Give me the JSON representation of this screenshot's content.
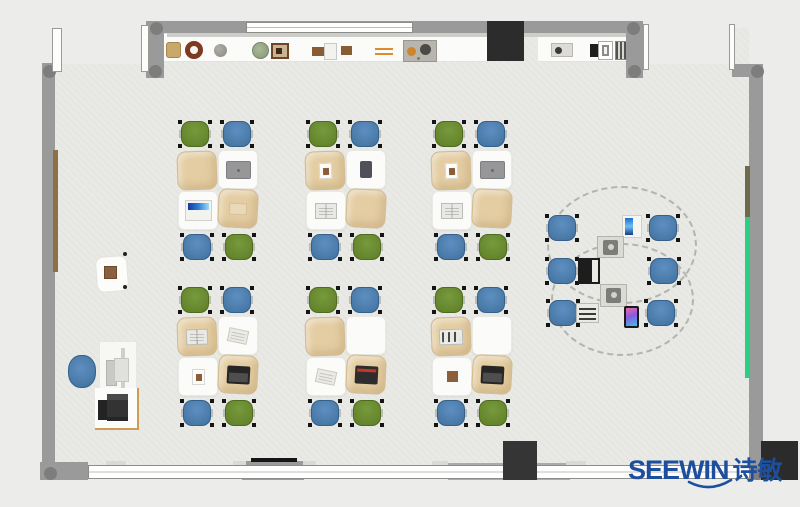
{
  "brand": {
    "name": "SEEWIN",
    "name_cn": "诗敏",
    "logo_color": "#1d4f9e"
  },
  "palette": {
    "bg": "#ececeb",
    "floor": "#e9e9e6",
    "wall": "#9a9a9a",
    "wall_joint": "#7d7d7d",
    "window_white": "#ffffff",
    "shelf_white": "#fbfbf9",
    "chair_green": "#5f7e28",
    "chair_blue": "#41719c",
    "desk_white": "#fbfbf9",
    "desk_tan": "#e4cda2",
    "tv_black": "#2c2c2c",
    "cabinet_dark": "#353535",
    "pillar_dark": "#2b2b2b",
    "strip_green": "#2bcf84",
    "strip_brown_left": "#8f6f45",
    "strip_brown_right": "#6f6b4a",
    "trim_tan": "#cf9d52"
  },
  "structure": {
    "floor": {
      "x": 55,
      "y": 28,
      "w": 694,
      "h": 439
    },
    "notches": [
      {
        "n": "door-recess-top-left",
        "x": 55,
        "y": 20,
        "w": 91,
        "h": 44
      },
      {
        "n": "door-recess-top-right",
        "x": 643,
        "y": 16,
        "w": 90,
        "h": 48
      }
    ],
    "walls": [
      {
        "n": "wall-top",
        "x": 150,
        "y": 21,
        "w": 490,
        "h": 12
      },
      {
        "n": "wall-top-left-pier",
        "x": 146,
        "y": 21,
        "w": 18,
        "h": 57
      },
      {
        "n": "wall-top-right-corner",
        "x": 626,
        "y": 21,
        "w": 17,
        "h": 57
      },
      {
        "n": "wall-top-right",
        "x": 732,
        "y": 64,
        "w": 31,
        "h": 13
      },
      {
        "n": "wall-right",
        "x": 749,
        "y": 64,
        "w": 14,
        "h": 416
      },
      {
        "n": "wall-left",
        "x": 42,
        "y": 63,
        "w": 13,
        "h": 404
      },
      {
        "n": "wall-bottom-left-corner",
        "x": 40,
        "y": 462,
        "w": 48,
        "h": 18
      },
      {
        "n": "wall-bottom-pier-center",
        "x": 242,
        "y": 461,
        "w": 62,
        "h": 19
      },
      {
        "n": "wall-bottom-pier-right",
        "x": 448,
        "y": 463,
        "w": 122,
        "h": 17,
        "bg": "#ababab"
      }
    ],
    "wall_edge": {
      "x": 167,
      "y": 33,
      "w": 460,
      "h": 4
    },
    "joints": [
      [
        150,
        22
      ],
      [
        627,
        22
      ],
      [
        149,
        65
      ],
      [
        628,
        65
      ],
      [
        751,
        65
      ],
      [
        43,
        65
      ],
      [
        44,
        467
      ],
      [
        751,
        467
      ]
    ],
    "windows": [
      {
        "n": "window-top",
        "x": 246,
        "y": 22,
        "w": 167,
        "h": 11
      },
      {
        "n": "window-bottom",
        "x": 88,
        "y": 465,
        "w": 662,
        "h": 14
      }
    ],
    "window_tabs": [
      [
        106,
        461,
        20
      ],
      [
        233,
        461,
        13
      ],
      [
        303,
        461,
        13
      ],
      [
        432,
        461,
        16
      ],
      [
        566,
        461,
        20
      ],
      [
        648,
        461,
        14
      ]
    ],
    "door_jambs": [
      [
        52,
        28,
        10,
        44
      ],
      [
        141,
        25,
        8,
        47
      ],
      [
        643,
        24,
        6,
        46
      ],
      [
        729,
        24,
        6,
        46
      ]
    ],
    "black_line": {
      "x": 251,
      "y": 458,
      "w": 46,
      "h": 4
    },
    "wall_strips": [
      {
        "n": "rail-brown-left",
        "x": 53,
        "y": 150,
        "w": 5,
        "h": 122,
        "bg": "#8f6f45"
      },
      {
        "n": "rail-brown-right",
        "x": 745,
        "y": 166,
        "w": 5,
        "h": 52,
        "bg": "#6f6b4a"
      },
      {
        "n": "rail-green-right",
        "x": 745,
        "y": 217,
        "w": 5,
        "h": 161,
        "bg": "#2bcf84"
      }
    ],
    "blocks": [
      {
        "n": "tv-panel",
        "x": 487,
        "y": 21,
        "w": 37,
        "h": 40,
        "bg": "#2c2c2c"
      },
      {
        "n": "cabinet-bottom",
        "x": 503,
        "y": 441,
        "w": 34,
        "h": 39,
        "bg": "#353535"
      },
      {
        "n": "pillar-bottom-right",
        "x": 761,
        "y": 441,
        "w": 37,
        "h": 39,
        "bg": "#2b2b2b"
      }
    ]
  },
  "shelf": {
    "bands": [
      {
        "x": 164,
        "y": 34,
        "w": 324,
        "h": 28
      },
      {
        "x": 538,
        "y": 34,
        "w": 108,
        "h": 28
      }
    ],
    "items": [
      {
        "t": "basket",
        "x": 166,
        "y": 42,
        "w": 15,
        "h": 16
      },
      {
        "t": "wreath",
        "x": 185,
        "y": 41,
        "w": 18,
        "h": 18
      },
      {
        "t": "ball",
        "x": 214,
        "y": 44,
        "w": 13,
        "h": 13
      },
      {
        "t": "plant",
        "x": 252,
        "y": 42,
        "w": 17,
        "h": 17
      },
      {
        "t": "frame",
        "x": 271,
        "y": 43,
        "w": 18,
        "h": 16
      },
      {
        "t": "box",
        "x": 312,
        "y": 47,
        "w": 13,
        "h": 9
      },
      {
        "t": "case",
        "x": 324,
        "y": 43,
        "w": 13,
        "h": 17
      },
      {
        "t": "box",
        "x": 341,
        "y": 46,
        "w": 11,
        "h": 9
      },
      {
        "t": "rails",
        "x": 375,
        "y": 48,
        "w": 18,
        "h": 7
      },
      {
        "t": "tray",
        "x": 403,
        "y": 40,
        "w": 34,
        "h": 22
      },
      {
        "t": "knob",
        "x": 551,
        "y": 43,
        "w": 22,
        "h": 14
      },
      {
        "t": "copier",
        "x": 590,
        "y": 41,
        "w": 23,
        "h": 18
      },
      {
        "t": "grille",
        "x": 615,
        "y": 41,
        "w": 13,
        "h": 19
      }
    ]
  },
  "clusters": [
    {
      "x": 177,
      "y": 119,
      "chairs": [
        "g",
        "b",
        "b",
        "g"
      ],
      "desks": [
        {
          "c": "tan",
          "i": "none"
        },
        {
          "c": "white",
          "i": "tabletgray"
        },
        {
          "c": "white",
          "i": "screenblue"
        },
        {
          "c": "tan",
          "i": "pencil"
        }
      ]
    },
    {
      "x": 305,
      "y": 119,
      "chairs": [
        "g",
        "b",
        "b",
        "g"
      ],
      "desks": [
        {
          "c": "tan",
          "i": "photo"
        },
        {
          "c": "white",
          "i": "tabletdark"
        },
        {
          "c": "white",
          "i": "book"
        },
        {
          "c": "tan",
          "i": "none"
        }
      ]
    },
    {
      "x": 431,
      "y": 119,
      "chairs": [
        "g",
        "b",
        "b",
        "g"
      ],
      "desks": [
        {
          "c": "tan",
          "i": "photo"
        },
        {
          "c": "white",
          "i": "tabletgray"
        },
        {
          "c": "white",
          "i": "book"
        },
        {
          "c": "tan",
          "i": "none"
        }
      ]
    },
    {
      "x": 177,
      "y": 285,
      "chairs": [
        "g",
        "b",
        "b",
        "g"
      ],
      "desks": [
        {
          "c": "tan",
          "i": "book"
        },
        {
          "c": "white",
          "i": "news"
        },
        {
          "c": "white",
          "i": "photo"
        },
        {
          "c": "tan",
          "i": "laptopdark"
        }
      ]
    },
    {
      "x": 305,
      "y": 285,
      "chairs": [
        "g",
        "b",
        "b",
        "g"
      ],
      "desks": [
        {
          "c": "tan",
          "i": "none"
        },
        {
          "c": "white",
          "i": "none"
        },
        {
          "c": "white",
          "i": "news"
        },
        {
          "c": "tan",
          "i": "laptopred"
        }
      ]
    },
    {
      "x": 431,
      "y": 285,
      "chairs": [
        "g",
        "b",
        "b",
        "g"
      ],
      "desks": [
        {
          "c": "tan",
          "i": "laptopwhite"
        },
        {
          "c": "white",
          "i": "none"
        },
        {
          "c": "white",
          "i": "brown"
        },
        {
          "c": "tan",
          "i": "laptopdark"
        }
      ]
    }
  ],
  "round_table": {
    "outlines": [
      {
        "x": 547,
        "y": 186,
        "w": 150,
        "h": 118
      },
      {
        "x": 551,
        "y": 243,
        "w": 143,
        "h": 113
      }
    ],
    "chairs": [
      [
        545,
        213
      ],
      [
        545,
        256
      ],
      [
        546,
        298
      ],
      [
        646,
        213
      ],
      [
        647,
        256
      ],
      [
        644,
        298
      ]
    ],
    "devices": [
      {
        "t": "screenv",
        "x": 622,
        "y": 215,
        "w": 20,
        "h": 23
      },
      {
        "t": "gdev",
        "x": 597,
        "y": 236,
        "w": 27,
        "h": 22
      },
      {
        "t": "laptopb",
        "x": 578,
        "y": 258,
        "w": 22,
        "h": 26
      },
      {
        "t": "gdev",
        "x": 600,
        "y": 284,
        "w": 27,
        "h": 23
      },
      {
        "t": "laptopw",
        "x": 576,
        "y": 303,
        "w": 23,
        "h": 20
      },
      {
        "t": "phone",
        "x": 624,
        "y": 306,
        "w": 15,
        "h": 22
      }
    ]
  },
  "teacher": {
    "pad": {
      "x": 96,
      "y": 256,
      "w": 32,
      "h": 36
    },
    "pad_item": {
      "x": 104,
      "y": 266,
      "w": 13,
      "h": 13
    },
    "pad_dots": [
      [
        123,
        252
      ],
      [
        123,
        285
      ]
    ],
    "chair": {
      "x": 65,
      "y": 352,
      "w": 34,
      "h": 39
    },
    "desk": {
      "x": 99,
      "y": 341,
      "w": 38,
      "h": 57
    },
    "printer_mat": {
      "x": 95,
      "y": 388,
      "w": 44,
      "h": 42
    },
    "printer": {
      "x": 98,
      "y": 394,
      "w": 30,
      "h": 28
    }
  }
}
